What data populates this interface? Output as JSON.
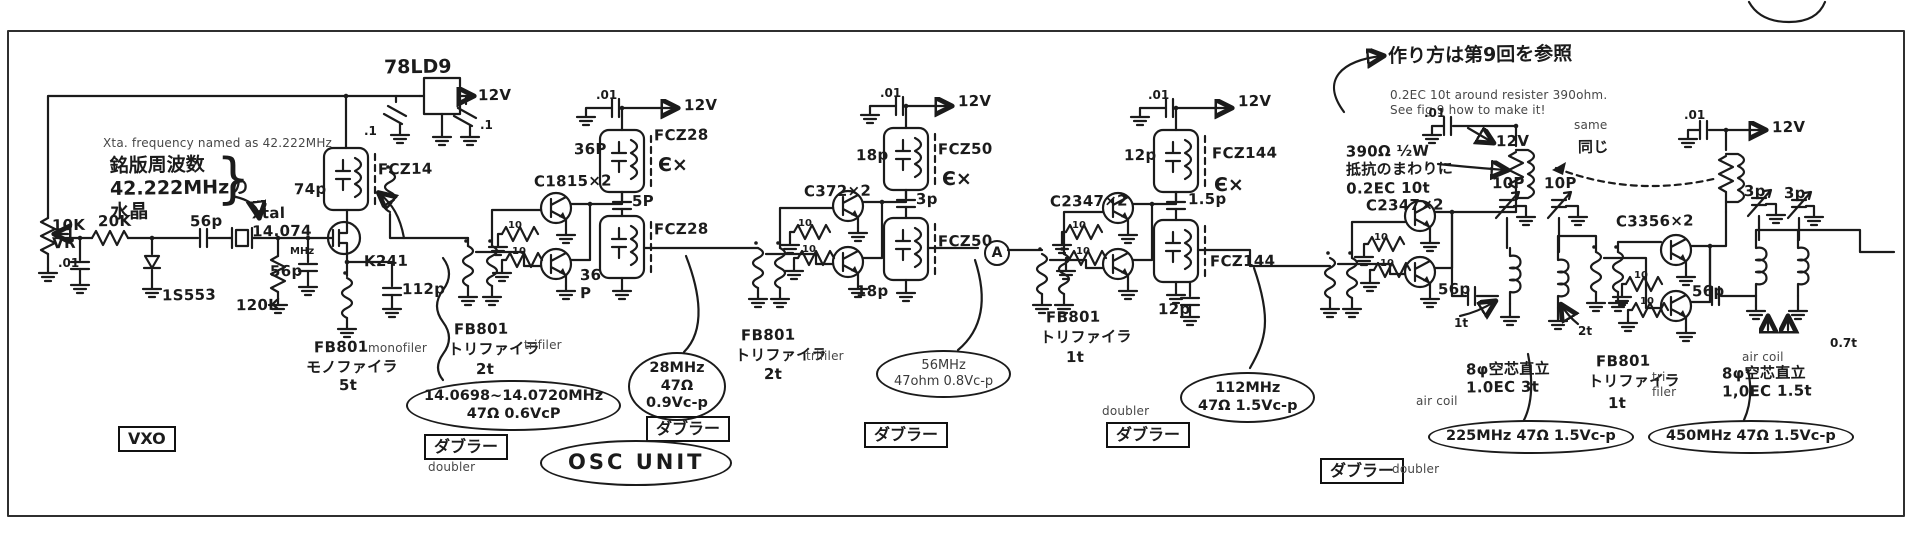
{
  "meta": {
    "ink_color": "#1b1b1b",
    "typed_color": "#474747",
    "paper_color": "#ffffff"
  },
  "annotations": [
    {
      "name": "xtal-freq-note-en",
      "x": 103,
      "y": 136,
      "cls": "typed",
      "text": "Xta. frequency named as 42.222MHz"
    },
    {
      "name": "nameplate-freq-jp",
      "x": 110,
      "y": 154,
      "cls": "hw-lg",
      "text": "銘版周波数\n42.222MHzの\n水晶"
    },
    {
      "name": "nameplate-brace",
      "x": 216,
      "y": 152,
      "cls": "brace",
      "text": "}"
    },
    {
      "name": "vr-10k-label",
      "x": 52,
      "y": 216,
      "cls": "hw",
      "text": "10K\nVR"
    },
    {
      "name": "r-20k-label",
      "x": 98,
      "y": 212,
      "cls": "hw",
      "text": "20K"
    },
    {
      "name": "c-56p-input-label",
      "x": 190,
      "y": 212,
      "cls": "hw",
      "text": "56p"
    },
    {
      "name": "c-01-input-label",
      "x": 58,
      "y": 256,
      "cls": "hw-sm",
      "text": ".01"
    },
    {
      "name": "d-1s553-label",
      "x": 162,
      "y": 286,
      "cls": "hw",
      "text": "1S553"
    },
    {
      "name": "xtal-label",
      "x": 252,
      "y": 204,
      "cls": "hw",
      "text": "xtal\n14.074"
    },
    {
      "name": "xtal-mhz-label",
      "x": 290,
      "y": 246,
      "cls": "hw-xs",
      "text": "MHz"
    },
    {
      "name": "r-120k-label",
      "x": 236,
      "y": 296,
      "cls": "hw",
      "text": "120K"
    },
    {
      "name": "c-56p-fet-label",
      "x": 270,
      "y": 262,
      "cls": "hw",
      "text": "56p"
    },
    {
      "name": "c-74p-label",
      "x": 294,
      "y": 180,
      "cls": "hw",
      "text": "74p"
    },
    {
      "name": "reg-78ld9-label",
      "x": 384,
      "y": 56,
      "cls": "hw-lg",
      "text": "78LD9"
    },
    {
      "name": "rail-12v-vxo",
      "x": 478,
      "y": 86,
      "cls": "hw",
      "text": "12V"
    },
    {
      "name": "c-p1-left-label",
      "x": 364,
      "y": 124,
      "cls": "hw-sm",
      "text": ".1"
    },
    {
      "name": "c-p1-right-label",
      "x": 480,
      "y": 118,
      "cls": "hw-sm",
      "text": ".1"
    },
    {
      "name": "fcz14-label",
      "x": 378,
      "y": 160,
      "cls": "hw",
      "text": "FCZ14"
    },
    {
      "name": "q-k241-label",
      "x": 364,
      "y": 252,
      "cls": "hw",
      "text": "K241"
    },
    {
      "name": "c-112p-label",
      "x": 402,
      "y": 280,
      "cls": "hw",
      "text": "112p"
    },
    {
      "name": "fb801-1-label",
      "x": 314,
      "y": 338,
      "cls": "hw",
      "text": "FB801"
    },
    {
      "name": "monofiler-typed",
      "x": 368,
      "y": 341,
      "cls": "typed",
      "text": "monofiler"
    },
    {
      "name": "fb801-1-jp",
      "x": 306,
      "y": 358,
      "cls": "hw",
      "text": "モノファイラ"
    },
    {
      "name": "fb801-1-turns",
      "x": 339,
      "y": 376,
      "cls": "hw",
      "text": "5t"
    },
    {
      "name": "vxo-box",
      "x": 118,
      "y": 426,
      "cls": "boxed",
      "text": "VXO"
    },
    {
      "name": "fb801-2-label",
      "x": 454,
      "y": 320,
      "cls": "hw",
      "text": "FB801"
    },
    {
      "name": "fb801-2-jp",
      "x": 448,
      "y": 340,
      "cls": "hw",
      "text": "トリファイラ"
    },
    {
      "name": "trifiler-typed-1",
      "x": 524,
      "y": 338,
      "cls": "typed",
      "text": "trifiler"
    },
    {
      "name": "fb801-2-turns",
      "x": 476,
      "y": 360,
      "cls": "hw",
      "text": "2t"
    },
    {
      "name": "vxo-range-oval",
      "x": 406,
      "y": 380,
      "cls": "oval",
      "text": "14.0698~14.0720MHz\n47Ω 0.6VcP"
    },
    {
      "name": "q-c1815-label",
      "x": 534,
      "y": 172,
      "cls": "hw",
      "text": "C1815×2"
    },
    {
      "name": "r10-s2a-label",
      "x": 508,
      "y": 220,
      "cls": "hw-xs",
      "text": "10"
    },
    {
      "name": "r10-s2b-label",
      "x": 512,
      "y": 246,
      "cls": "hw-xs",
      "text": "10"
    },
    {
      "name": "c01-s2-label",
      "x": 596,
      "y": 88,
      "cls": "hw-sm",
      "text": ".01"
    },
    {
      "name": "rail-12v-s2",
      "x": 684,
      "y": 96,
      "cls": "hw",
      "text": "12V"
    },
    {
      "name": "c36p-s2a-label",
      "x": 574,
      "y": 140,
      "cls": "hw",
      "text": "36P"
    },
    {
      "name": "fcz28-a-label",
      "x": 654,
      "y": 126,
      "cls": "hw",
      "text": "FCZ28"
    },
    {
      "name": "tune-mark-1",
      "x": 658,
      "y": 154,
      "cls": "hw-lg",
      "text": "Є×"
    },
    {
      "name": "c5p-s2-label",
      "x": 632,
      "y": 192,
      "cls": "hw",
      "text": "5P"
    },
    {
      "name": "fcz28-b-label",
      "x": 654,
      "y": 220,
      "cls": "hw",
      "text": "FCZ28"
    },
    {
      "name": "c36p-s2b-label",
      "x": 580,
      "y": 266,
      "cls": "hw",
      "text": "36\nP"
    },
    {
      "name": "doubler-box-1",
      "x": 424,
      "y": 434,
      "cls": "boxed",
      "text": "ダブラー"
    },
    {
      "name": "doubler-typed-1",
      "x": 428,
      "y": 460,
      "cls": "typed",
      "text": "doubler"
    },
    {
      "name": "meas-28mhz-oval",
      "x": 628,
      "y": 352,
      "cls": "oval",
      "text": "28MHz\n47Ω\n0.9Vc-p"
    },
    {
      "name": "fb801-3-label",
      "x": 741,
      "y": 326,
      "cls": "hw",
      "text": "FB801"
    },
    {
      "name": "fb801-3-jp",
      "x": 735,
      "y": 346,
      "cls": "hw",
      "text": "トリファイラ"
    },
    {
      "name": "trifiler-typed-2",
      "x": 806,
      "y": 349,
      "cls": "typed",
      "text": "trifiler"
    },
    {
      "name": "fb801-3-turns",
      "x": 764,
      "y": 365,
      "cls": "hw",
      "text": "2t"
    },
    {
      "name": "q-c372-label",
      "x": 804,
      "y": 182,
      "cls": "hw",
      "text": "C372×2"
    },
    {
      "name": "r10-s3a-label",
      "x": 798,
      "y": 218,
      "cls": "hw-xs",
      "text": "10"
    },
    {
      "name": "r10-s3b-label",
      "x": 802,
      "y": 244,
      "cls": "hw-xs",
      "text": "10"
    },
    {
      "name": "c18p-s3a-label",
      "x": 856,
      "y": 146,
      "cls": "hw",
      "text": "18p"
    },
    {
      "name": "c01-s3-label",
      "x": 880,
      "y": 86,
      "cls": "hw-sm",
      "text": ".01"
    },
    {
      "name": "rail-12v-s3",
      "x": 958,
      "y": 92,
      "cls": "hw",
      "text": "12V"
    },
    {
      "name": "fcz50-a-label",
      "x": 938,
      "y": 140,
      "cls": "hw",
      "text": "FCZ50"
    },
    {
      "name": "tune-mark-2",
      "x": 942,
      "y": 168,
      "cls": "hw-lg",
      "text": "Є×"
    },
    {
      "name": "c3p-s3-label",
      "x": 916,
      "y": 190,
      "cls": "hw",
      "text": "3p"
    },
    {
      "name": "fcz50-b-label",
      "x": 938,
      "y": 232,
      "cls": "hw",
      "text": "FCZ50"
    },
    {
      "name": "point-a-circle",
      "x": 984,
      "y": 240,
      "cls": "circled",
      "text": "A"
    },
    {
      "name": "c18p-s3b-label",
      "x": 856,
      "y": 282,
      "cls": "hw",
      "text": "18p"
    },
    {
      "name": "meas-56mhz-oval",
      "x": 876,
      "y": 350,
      "cls": "oval typed-oval",
      "text": "56MHz\n47ohm 0.8Vc-p"
    },
    {
      "name": "doubler-box-2",
      "x": 646,
      "y": 416,
      "cls": "boxed",
      "text": "ダブラー"
    },
    {
      "name": "doubler-box-3",
      "x": 864,
      "y": 422,
      "cls": "boxed",
      "text": "ダブラー"
    },
    {
      "name": "q-c2347a-label",
      "x": 1050,
      "y": 192,
      "cls": "hw",
      "text": "C2347×2"
    },
    {
      "name": "r10-s4a-label",
      "x": 1072,
      "y": 220,
      "cls": "hw-xs",
      "text": "10"
    },
    {
      "name": "r10-s4b-label",
      "x": 1076,
      "y": 246,
      "cls": "hw-xs",
      "text": "10"
    },
    {
      "name": "c12p-s4a-label",
      "x": 1124,
      "y": 146,
      "cls": "hw",
      "text": "12p"
    },
    {
      "name": "c01-s4-label",
      "x": 1148,
      "y": 88,
      "cls": "hw-sm",
      "text": ".01"
    },
    {
      "name": "rail-12v-s4",
      "x": 1238,
      "y": 92,
      "cls": "hw",
      "text": "12V"
    },
    {
      "name": "fcz144-a-label",
      "x": 1212,
      "y": 144,
      "cls": "hw",
      "text": "FCZ144"
    },
    {
      "name": "tune-mark-3",
      "x": 1214,
      "y": 174,
      "cls": "hw-lg",
      "text": "Є×"
    },
    {
      "name": "c15p-s4-label",
      "x": 1188,
      "y": 190,
      "cls": "hw",
      "text": "1.5p"
    },
    {
      "name": "fcz144-b-label",
      "x": 1210,
      "y": 252,
      "cls": "hw",
      "text": "FCZ144"
    },
    {
      "name": "c12p-s4b-label",
      "x": 1158,
      "y": 300,
      "cls": "hw",
      "text": "12p"
    },
    {
      "name": "fb801-4-label",
      "x": 1046,
      "y": 308,
      "cls": "hw",
      "text": "FB801"
    },
    {
      "name": "fb801-4-jp",
      "x": 1040,
      "y": 328,
      "cls": "hw",
      "text": "トリファイラ"
    },
    {
      "name": "fb801-4-turns",
      "x": 1066,
      "y": 348,
      "cls": "hw",
      "text": "1t"
    },
    {
      "name": "doubler-typed-2",
      "x": 1102,
      "y": 404,
      "cls": "typed",
      "text": "doubler"
    },
    {
      "name": "doubler-box-4",
      "x": 1106,
      "y": 422,
      "cls": "boxed",
      "text": "ダブラー"
    },
    {
      "name": "meas-112mhz-oval",
      "x": 1180,
      "y": 372,
      "cls": "oval",
      "text": "112MHz\n47Ω 1.5Vc-p"
    },
    {
      "name": "howto-note-jp",
      "x": 1388,
      "y": 44,
      "cls": "hw-lg",
      "text": "作り方は第9回を参照"
    },
    {
      "name": "howto-note-en",
      "x": 1390,
      "y": 88,
      "cls": "typed",
      "text": "0.2EC 10t around resister 390ohm.\nSee fig 9 how to make it!"
    },
    {
      "name": "same-typed",
      "x": 1574,
      "y": 118,
      "cls": "typed",
      "text": "same"
    },
    {
      "name": "same-jp",
      "x": 1578,
      "y": 138,
      "cls": "hw",
      "text": "同じ"
    },
    {
      "name": "r390-note",
      "x": 1346,
      "y": 142,
      "cls": "hw",
      "text": "390Ω ½W\n抵抗のまわりに\n0.2EC 10t"
    },
    {
      "name": "q-c2347b-label",
      "x": 1366,
      "y": 196,
      "cls": "hw",
      "text": "C2347×2"
    },
    {
      "name": "r10-s5a-label",
      "x": 1374,
      "y": 232,
      "cls": "hw-xs",
      "text": "10"
    },
    {
      "name": "r10-s5b-label",
      "x": 1380,
      "y": 258,
      "cls": "hw-xs",
      "text": "10"
    },
    {
      "name": "c01-s5-label",
      "x": 1424,
      "y": 106,
      "cls": "hw-sm",
      "text": ".01"
    },
    {
      "name": "rail-12v-s5",
      "x": 1496,
      "y": 132,
      "cls": "hw",
      "text": "12V"
    },
    {
      "name": "c10p-a-label",
      "x": 1492,
      "y": 174,
      "cls": "hw",
      "text": "10P"
    },
    {
      "name": "c10p-b-label",
      "x": 1544,
      "y": 174,
      "cls": "hw",
      "text": "10P"
    },
    {
      "name": "c56p-s5-label",
      "x": 1438,
      "y": 280,
      "cls": "hw",
      "text": "56p"
    },
    {
      "name": "tap-1t-s5-label",
      "x": 1454,
      "y": 316,
      "cls": "hw-sm",
      "text": "1t"
    },
    {
      "name": "tap-2t-s5-label",
      "x": 1578,
      "y": 324,
      "cls": "hw-sm",
      "text": "2t"
    },
    {
      "name": "aircoil-typed-1",
      "x": 1416,
      "y": 394,
      "cls": "typed",
      "text": "air coil"
    },
    {
      "name": "aircoil-note-1",
      "x": 1466,
      "y": 360,
      "cls": "hw",
      "text": "8φ空芯直立\n1.0EC 3t"
    },
    {
      "name": "meas-225mhz-oval",
      "x": 1428,
      "y": 420,
      "cls": "oval",
      "text": "225MHz 47Ω 1.5Vc-p"
    },
    {
      "name": "doubler-box-5",
      "x": 1320,
      "y": 458,
      "cls": "boxed",
      "text": "ダブラー"
    },
    {
      "name": "doubler-typed-3",
      "x": 1392,
      "y": 462,
      "cls": "typed",
      "text": "doubler"
    },
    {
      "name": "fb801-6-label",
      "x": 1596,
      "y": 352,
      "cls": "hw",
      "text": "FB801"
    },
    {
      "name": "fb801-6-jp",
      "x": 1588,
      "y": 372,
      "cls": "hw",
      "text": "トリファイラ"
    },
    {
      "name": "trifiler-typed-3",
      "x": 1652,
      "y": 370,
      "cls": "typed",
      "text": "tri-\nfiler"
    },
    {
      "name": "fb801-6-turns",
      "x": 1608,
      "y": 394,
      "cls": "hw",
      "text": "1t"
    },
    {
      "name": "q-c3356-label",
      "x": 1616,
      "y": 212,
      "cls": "hw",
      "text": "C3356×2"
    },
    {
      "name": "r10-s6a-label",
      "x": 1634,
      "y": 270,
      "cls": "hw-xs",
      "text": "10"
    },
    {
      "name": "r10-s6b-label",
      "x": 1640,
      "y": 296,
      "cls": "hw-xs",
      "text": "10"
    },
    {
      "name": "c01-s6-label",
      "x": 1684,
      "y": 108,
      "cls": "hw-sm",
      "text": ".01"
    },
    {
      "name": "rail-12v-s6",
      "x": 1772,
      "y": 118,
      "cls": "hw",
      "text": "12V"
    },
    {
      "name": "c3p-a-label",
      "x": 1744,
      "y": 182,
      "cls": "hw",
      "text": "3p"
    },
    {
      "name": "c3p-b-label",
      "x": 1784,
      "y": 184,
      "cls": "hw",
      "text": "3p"
    },
    {
      "name": "c56p-s6-label",
      "x": 1692,
      "y": 282,
      "cls": "hw",
      "text": "56p"
    },
    {
      "name": "tap-07t-s6-label",
      "x": 1830,
      "y": 336,
      "cls": "hw-sm",
      "text": "0.7t"
    },
    {
      "name": "aircoil-typed-2",
      "x": 1742,
      "y": 350,
      "cls": "typed",
      "text": "air coil"
    },
    {
      "name": "aircoil-note-2",
      "x": 1722,
      "y": 364,
      "cls": "hw",
      "text": "8φ空芯直立\n1,0EC 1.5t"
    },
    {
      "name": "meas-450mhz-oval",
      "x": 1648,
      "y": 420,
      "cls": "oval",
      "text": "450MHz 47Ω 1.5Vc-p"
    },
    {
      "name": "osc-unit-oval",
      "x": 540,
      "y": 440,
      "cls": "oval osc",
      "text": "OSC UNIT"
    }
  ]
}
